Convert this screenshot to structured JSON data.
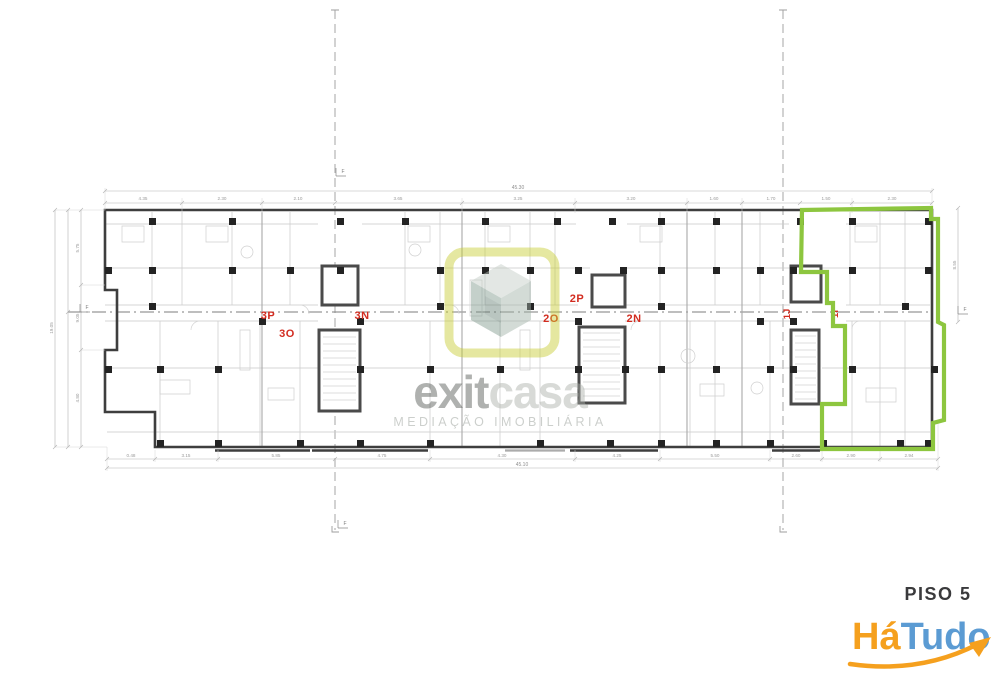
{
  "plan": {
    "floor_label": "PISO 5",
    "units": [
      {
        "id": "3P"
      },
      {
        "id": "3O"
      },
      {
        "id": "3N"
      },
      {
        "id": "2P"
      },
      {
        "id": "2O"
      },
      {
        "id": "2N"
      },
      {
        "id": "1J"
      },
      {
        "id": "1I"
      }
    ],
    "highlight_color": "#8dc63f",
    "unit_label_color": "#d22c20",
    "section_marker": "F",
    "dims": {
      "top_overall": "45.30",
      "bottom_overall": "45.10",
      "top_segments": [
        "4.35",
        "2.30",
        "2.10",
        "3.65",
        "3.25",
        "3.20",
        "1.60",
        "1.70",
        "1.50",
        "2.30"
      ],
      "bottom_segments": [
        "0.48",
        "3.15",
        "5.85",
        "4.75",
        "4.30",
        "4.25",
        "5.50",
        "2.60",
        "2.90",
        "2.94"
      ],
      "left_segments": [
        "5.75",
        "9.05",
        "4.80"
      ],
      "left_overall": "19.05",
      "right_overall": "8.55"
    }
  },
  "watermark": {
    "brand_bold": "exit",
    "brand_light": "casa",
    "tagline": "MEDIAÇÃO IMOBILIÁRIA",
    "frame_color": "#c6cc2e"
  },
  "branding": {
    "floor_caption": "PISO 5",
    "brand_part1": "Há",
    "brand_part2": "Tudo",
    "part1_color": "#f5a01e",
    "part2_color": "#5b9bd3"
  }
}
